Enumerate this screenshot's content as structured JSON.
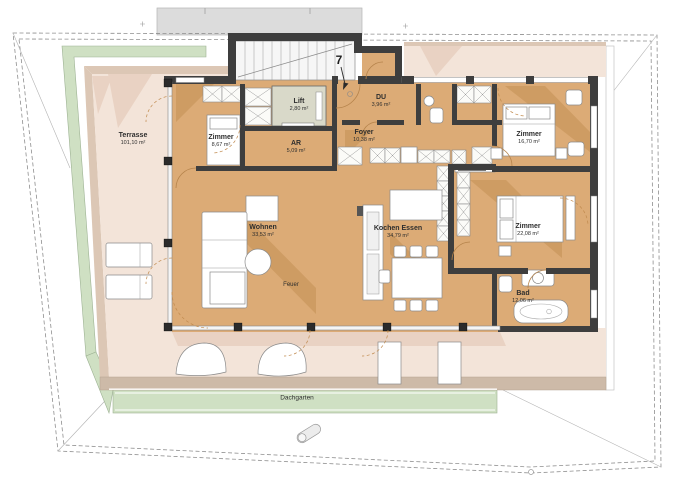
{
  "plan": {
    "rooms": {
      "terrasse": {
        "name": "Terrasse",
        "area": "101,10 m²"
      },
      "zimmer1": {
        "name": "Zimmer",
        "area": "8,67 m²"
      },
      "lift": {
        "name": "Lift",
        "area": "2,80 m²"
      },
      "ar": {
        "name": "AR",
        "area": "5,09 m²"
      },
      "du": {
        "name": "DU",
        "area": "3,96 m²"
      },
      "foyer": {
        "name": "Foyer",
        "area": "10,38 m²"
      },
      "zimmer2": {
        "name": "Zimmer",
        "area": "16,70 m²"
      },
      "zimmer3": {
        "name": "Zimmer",
        "area": "22,08 m²"
      },
      "wohnen": {
        "name": "Wohnen",
        "area": "33,53 m²"
      },
      "kochen": {
        "name": "Kochen Essen",
        "area": "34,79 m²"
      },
      "bad": {
        "name": "Bad",
        "area": "12,06 m²"
      }
    },
    "annotations": {
      "unit_number": "7",
      "fireplace": "Feuer",
      "roof_garden": "Dachgarten"
    },
    "colors": {
      "floor": "#dcab76",
      "terrace": "#f3e4d9",
      "roof_garden": "#cfe0c3",
      "wall": "#3e3e3e",
      "stair_roof": "#dcdcdc"
    }
  }
}
